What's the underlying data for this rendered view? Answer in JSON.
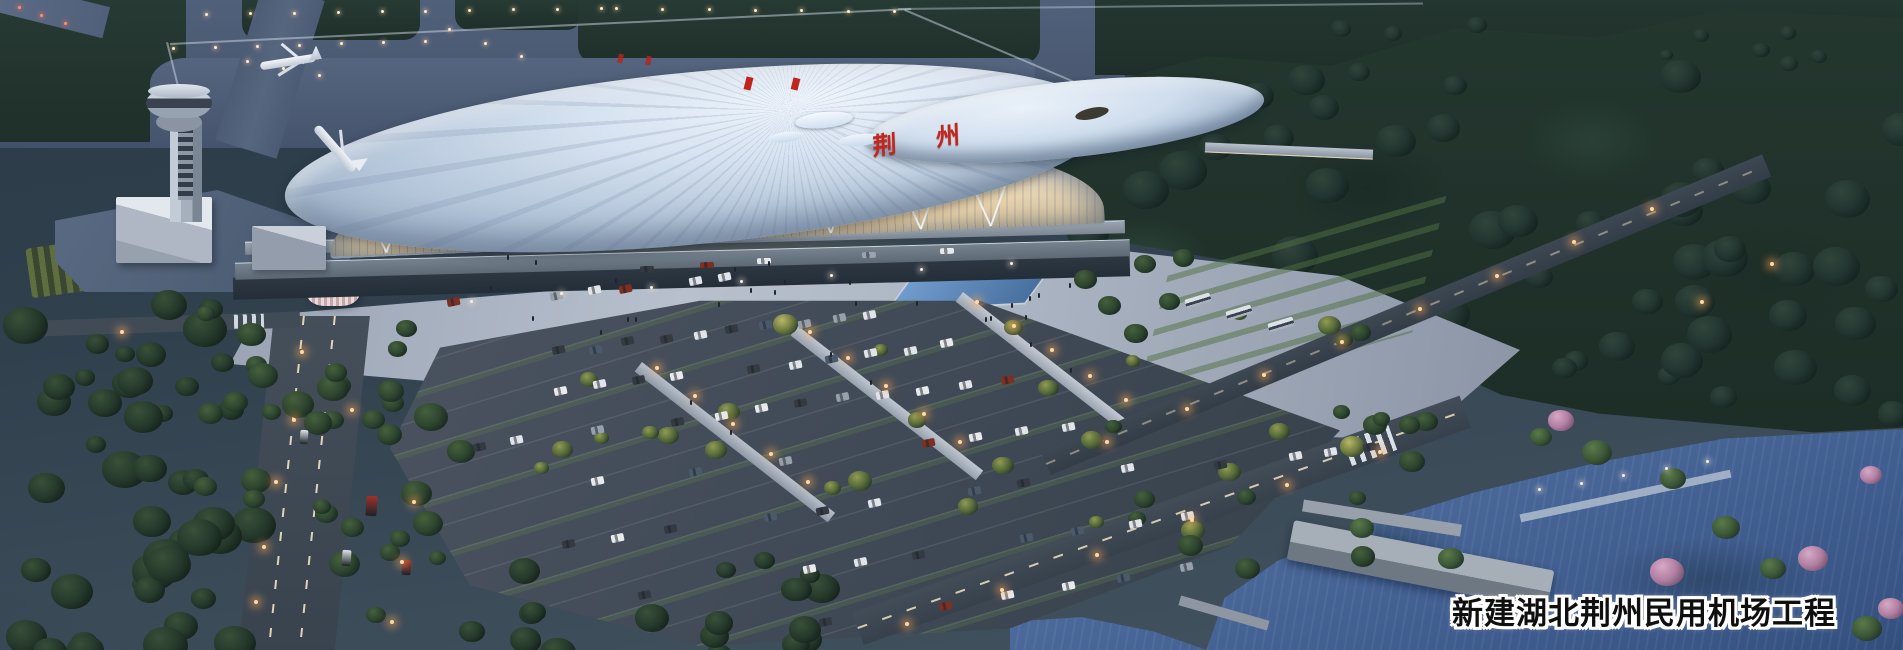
{
  "meta": {
    "type": "architectural-rendering",
    "scene": "Aerial dusk rendering of a new civil airport: control tower, taxiways with aircraft, terminal with flowing white roof and glowing glass facade, tree-lined parking lots, roads, forest and lakeside landscape"
  },
  "texts": {
    "caption": "新建湖北荆州民用机场工程",
    "roof_sign": "荆州"
  },
  "colors": {
    "dusk_base": "#30404d",
    "field_green": "#243731",
    "forest_green": "#20322b",
    "taxiway_gray": "#4e5d74",
    "roof_white": "#d6e2f0",
    "facade_glow": "#f2cf98",
    "sign_red": "#c2261c",
    "asphalt": "#434d59",
    "plaza_gray": "#aab3c1",
    "water_blue": "#44639a",
    "lamp_warm": "#ffc27c",
    "blossom_pink": "#c08bb0",
    "caption_fill": "#0f0f10",
    "caption_outline": "#ffffff"
  }
}
